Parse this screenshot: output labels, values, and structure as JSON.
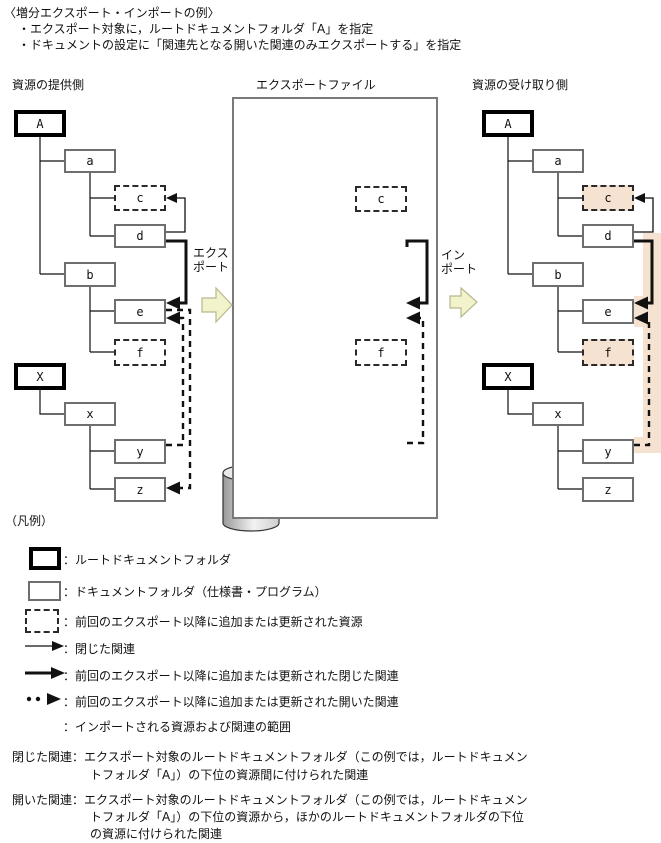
{
  "title": {
    "line1": "〈増分エクスポート・インポートの例〉",
    "line2": "・エクスポート対象に，ルートドキュメントフォルダ「A」を指定",
    "line3": "・ドキュメントの設定に「関連先となる開いた関連のみエクスポートする」を指定"
  },
  "columns": {
    "provider": "資源の提供側",
    "export_file": "エクスポートファイル",
    "receiver": "資源の受け取り側"
  },
  "flow": {
    "export_line1": "エクス",
    "export_line2": "ポート",
    "import_line1": "イン",
    "import_line2": "ポート"
  },
  "node_labels": {
    "A": "A",
    "a": "a",
    "b": "b",
    "c": "c",
    "d": "d",
    "e": "e",
    "f": "f",
    "X": "X",
    "x": "x",
    "y": "y",
    "z": "z"
  },
  "legend": {
    "heading": "（凡例）",
    "items": [
      {
        "symbol": "root-folder-box",
        "label": "：ルートドキュメントフォルダ"
      },
      {
        "symbol": "document-folder-box",
        "label": "：ドキュメントフォルダ（仕様書・プログラム）"
      },
      {
        "symbol": "added-updated-resource-box",
        "label": "：前回のエクスポート以降に追加または更新された資源"
      },
      {
        "symbol": "closed-relation-arrow",
        "label": "：閉じた関連"
      },
      {
        "symbol": "added-updated-closed-relation-arrow",
        "label": "：前回のエクスポート以降に追加または更新された閉じた関連"
      },
      {
        "symbol": "added-updated-open-relation-arrow",
        "label": "：前回のエクスポート以降に追加または更新された開いた関連"
      },
      {
        "symbol": "import-scope-swatch",
        "label": "：インポートされる資源および関連の範囲"
      }
    ],
    "closed_note": {
      "term": "閉じた関連：",
      "lines": [
        "エクスポート対象のルートドキュメントフォルダ（この例では，ルートドキュメン",
        "トフォルダ「A」）の下位の資源間に付けられた関連"
      ]
    },
    "open_note": {
      "term": "開いた関連：",
      "lines": [
        "エクスポート対象のルートドキュメントフォルダ（この例では，ルートドキュメン",
        "トフォルダ「A」）の下位の資源から，ほかのルートドキュメントフォルダの下位",
        "の資源に付けられた関連"
      ]
    }
  },
  "colors": {
    "import_highlight": "#f5e2d0",
    "flow_arrow_fill": "#f3f3cb",
    "flow_arrow_border": "#b8b890",
    "root_border": "#000000",
    "doc_border": "#6e6e6e",
    "file_box_border": "#7a7a7a"
  }
}
